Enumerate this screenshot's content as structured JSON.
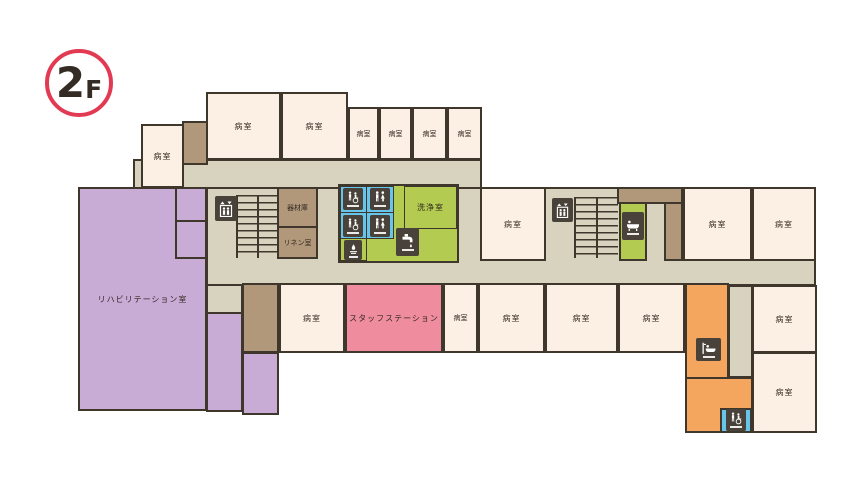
{
  "floor_badge": {
    "number": "2",
    "suffix": "F"
  },
  "rooms": {
    "ward": "病室",
    "rehabilitation": "リハビリテーション室",
    "equipment_storage": "器材庫",
    "linen": "リネン室",
    "washing": "洗浄室",
    "staff_station": "スタッフステーション"
  },
  "icons": [
    "elevator-icon",
    "stairs-icon",
    "toilet-icon",
    "accessible-toilet-icon",
    "handwash-icon",
    "faucet-icon",
    "bathtub-icon",
    "assisted-bath-icon"
  ],
  "colors": {
    "wall": "#3f362c",
    "ward_cream": "#fcefe3",
    "corridor_beige": "#d8d3bf",
    "storage_brown": "#b2987b",
    "rehab_purple": "#c9acd6",
    "staff_pink": "#ef8d9e",
    "wash_green": "#b3cb51",
    "toilet_blue": "#67c4ea",
    "bath_orange": "#f4a55e",
    "badge_red": "#e23a52",
    "icon_dark": "#48423a"
  }
}
